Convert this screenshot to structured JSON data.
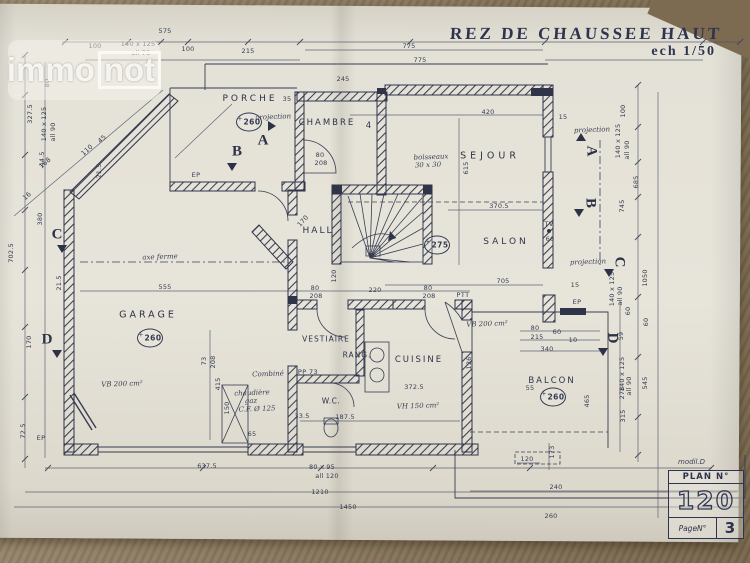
{
  "photo": {
    "table_color": "#8a795f",
    "paper_color": "#e4e1d7",
    "ink_color": "#30354a"
  },
  "watermark": {
    "immo": "immo",
    "not": "not"
  },
  "title": {
    "main": "REZ DE CHAUSSEE HAUT",
    "scale": "ech 1/50"
  },
  "title_block": {
    "model": "modil.D",
    "plan_label": "PLAN N°",
    "plan_number": "120",
    "page_label": "PageN°",
    "page_number": "3"
  },
  "rooms": [
    {
      "label": "PORCHE",
      "x": 250,
      "y": 99,
      "fs": 9,
      "ls": 3
    },
    {
      "label": "CHAMBRE",
      "x": 327,
      "y": 123,
      "fs": 8.5,
      "ls": 2
    },
    {
      "label": "4",
      "x": 370,
      "y": 126,
      "fs": 8.5,
      "ls": 0
    },
    {
      "label": "SEJOUR",
      "x": 490,
      "y": 156,
      "fs": 9.5,
      "ls": 4
    },
    {
      "label": "HALL",
      "x": 318,
      "y": 231,
      "fs": 9,
      "ls": 2
    },
    {
      "label": "SALON",
      "x": 506,
      "y": 242,
      "fs": 9,
      "ls": 3
    },
    {
      "label": "GARAGE",
      "x": 148,
      "y": 315,
      "fs": 9.5,
      "ls": 3
    },
    {
      "label": "VESTIAIRE",
      "x": 326,
      "y": 339,
      "fs": 7.5,
      "ls": 1
    },
    {
      "label": "RANG.",
      "x": 357,
      "y": 355,
      "fs": 7.5,
      "ls": 1
    },
    {
      "label": "CUISINE",
      "x": 419,
      "y": 360,
      "fs": 8.5,
      "ls": 2
    },
    {
      "label": "W.C.",
      "x": 331,
      "y": 401,
      "fs": 7.5,
      "ls": 0.5
    },
    {
      "label": "BALCON",
      "x": 552,
      "y": 381,
      "fs": 8.5,
      "ls": 2
    }
  ],
  "level_markers": [
    {
      "value": "260",
      "x": 249,
      "y": 122
    },
    {
      "value": "275",
      "x": 437,
      "y": 245
    },
    {
      "value": "260",
      "x": 150,
      "y": 338
    },
    {
      "value": "260",
      "x": 553,
      "y": 397
    }
  ],
  "section_markers": [
    {
      "letter": "A",
      "x": 263,
      "y": 141,
      "rot": 0,
      "tx": 272,
      "ty": 126,
      "dir": "right"
    },
    {
      "letter": "B",
      "x": 237,
      "y": 152,
      "rot": 0,
      "tx": 232,
      "ty": 167,
      "dir": "down"
    },
    {
      "letter": "A",
      "x": 591,
      "y": 151,
      "rot": 90,
      "tx": 581,
      "ty": 137,
      "dir": "up"
    },
    {
      "letter": "B",
      "x": 590,
      "y": 203,
      "rot": 90,
      "tx": 579,
      "ty": 213,
      "dir": "down"
    },
    {
      "letter": "C",
      "x": 57,
      "y": 235,
      "rot": 0,
      "tx": 62,
      "ty": 249,
      "dir": "down"
    },
    {
      "letter": "C",
      "x": 619,
      "y": 262,
      "rot": 90,
      "tx": 609,
      "ty": 273,
      "dir": "down"
    },
    {
      "letter": "D",
      "x": 47,
      "y": 340,
      "rot": 0,
      "tx": 57,
      "ty": 354,
      "dir": "down"
    },
    {
      "letter": "D",
      "x": 612,
      "y": 338,
      "rot": 90,
      "tx": 603,
      "ty": 352,
      "dir": "down"
    }
  ],
  "annotations": {
    "script": [
      {
        "t": "projection",
        "x": 273,
        "y": 117
      },
      {
        "t": "projection",
        "x": 592,
        "y": 130
      },
      {
        "t": "projection",
        "x": 588,
        "y": 262
      },
      {
        "t": "axe ferme",
        "x": 160,
        "y": 257
      },
      {
        "t": "boisseaux",
        "x": 431,
        "y": 157
      },
      {
        "t": "30 x 30",
        "x": 428,
        "y": 165
      },
      {
        "t": "VB 200 cm²",
        "x": 122,
        "y": 384
      },
      {
        "t": "VB 200 cm²",
        "x": 487,
        "y": 324
      },
      {
        "t": "VH 150 cm²",
        "x": 418,
        "y": 406
      },
      {
        "t": "chaudière",
        "x": 252,
        "y": 393
      },
      {
        "t": "gaz",
        "x": 251,
        "y": 401
      },
      {
        "t": "C.F. Ø 125",
        "x": 257,
        "y": 409
      },
      {
        "t": "Combiné",
        "x": 268,
        "y": 374
      }
    ],
    "print": [
      {
        "t": "TV",
        "x": 549,
        "y": 224
      },
      {
        "t": "PTT",
        "x": 463,
        "y": 295
      },
      {
        "t": "EP",
        "x": 196,
        "y": 175
      },
      {
        "t": "EP",
        "x": 577,
        "y": 302
      },
      {
        "t": "EP",
        "x": 41,
        "y": 438
      },
      {
        "t": "PP 73",
        "x": 308,
        "y": 372
      }
    ]
  },
  "dimensions": [
    {
      "t": "575",
      "x": 165,
      "y": 31,
      "r": 0
    },
    {
      "t": "100",
      "x": 95,
      "y": 46,
      "r": 0
    },
    {
      "t": "140 x 125",
      "x": 138,
      "y": 44,
      "r": 0
    },
    {
      "t": "all 75",
      "x": 141,
      "y": 53,
      "r": 0
    },
    {
      "t": "100",
      "x": 188,
      "y": 49,
      "r": 0
    },
    {
      "t": "215",
      "x": 248,
      "y": 51,
      "r": 0
    },
    {
      "t": "775",
      "x": 409,
      "y": 46,
      "r": 0
    },
    {
      "t": "775",
      "x": 420,
      "y": 60,
      "r": 0
    },
    {
      "t": "245",
      "x": 343,
      "y": 79,
      "r": 0
    },
    {
      "t": "35",
      "x": 287,
      "y": 99,
      "r": 0
    },
    {
      "t": "80",
      "x": 47,
      "y": 83,
      "r": -90
    },
    {
      "t": "327.5",
      "x": 30,
      "y": 114,
      "r": -90
    },
    {
      "t": "140 x 125",
      "x": 44,
      "y": 124,
      "r": -90
    },
    {
      "t": "all 90",
      "x": 53,
      "y": 132,
      "r": -90
    },
    {
      "t": "44.5",
      "x": 42,
      "y": 159,
      "r": -90
    },
    {
      "t": "380",
      "x": 40,
      "y": 219,
      "r": -90
    },
    {
      "t": "702.5",
      "x": 11,
      "y": 253,
      "r": -90
    },
    {
      "t": "21.5",
      "x": 99,
      "y": 171,
      "r": -90
    },
    {
      "t": "21.5",
      "x": 59,
      "y": 283,
      "r": -90
    },
    {
      "t": "170",
      "x": 29,
      "y": 342,
      "r": -90
    },
    {
      "t": "72.5",
      "x": 23,
      "y": 431,
      "r": -90
    },
    {
      "t": "168",
      "x": 45,
      "y": 163,
      "r": -42
    },
    {
      "t": "110",
      "x": 87,
      "y": 150,
      "r": -42
    },
    {
      "t": "16",
      "x": 27,
      "y": 196,
      "r": -42
    },
    {
      "t": "45",
      "x": 102,
      "y": 139,
      "r": -42
    },
    {
      "t": "100",
      "x": 623,
      "y": 111,
      "r": -90
    },
    {
      "t": "140 x 125",
      "x": 618,
      "y": 141,
      "r": -90
    },
    {
      "t": "all 90",
      "x": 627,
      "y": 150,
      "r": -90
    },
    {
      "t": "685",
      "x": 636,
      "y": 182,
      "r": -90
    },
    {
      "t": "745",
      "x": 622,
      "y": 206,
      "r": -90
    },
    {
      "t": "1050",
      "x": 645,
      "y": 278,
      "r": -90
    },
    {
      "t": "140 x 125",
      "x": 612,
      "y": 289,
      "r": -90
    },
    {
      "t": "all 90",
      "x": 620,
      "y": 296,
      "r": -90
    },
    {
      "t": "60",
      "x": 628,
      "y": 311,
      "r": -90
    },
    {
      "t": "60",
      "x": 646,
      "y": 322,
      "r": -90
    },
    {
      "t": "59",
      "x": 621,
      "y": 336,
      "r": -90
    },
    {
      "t": "140 x 125",
      "x": 622,
      "y": 374,
      "r": -90
    },
    {
      "t": "all 90",
      "x": 629,
      "y": 386,
      "r": -90
    },
    {
      "t": "278",
      "x": 622,
      "y": 393,
      "r": -90
    },
    {
      "t": "315",
      "x": 623,
      "y": 416,
      "r": -90
    },
    {
      "t": "545",
      "x": 645,
      "y": 383,
      "r": -90
    },
    {
      "t": "465",
      "x": 587,
      "y": 401,
      "r": -90
    },
    {
      "t": "637.5",
      "x": 207,
      "y": 466,
      "r": 0
    },
    {
      "t": "80 x 95",
      "x": 322,
      "y": 467,
      "r": 0
    },
    {
      "t": "all 120",
      "x": 327,
      "y": 476,
      "r": 0
    },
    {
      "t": "1210",
      "x": 320,
      "y": 492,
      "r": 0
    },
    {
      "t": "1450",
      "x": 348,
      "y": 507,
      "r": 0
    },
    {
      "t": "120",
      "x": 527,
      "y": 459,
      "r": 0
    },
    {
      "t": "173",
      "x": 552,
      "y": 452,
      "r": -90
    },
    {
      "t": "240",
      "x": 556,
      "y": 487,
      "r": 0
    },
    {
      "t": "260",
      "x": 551,
      "y": 516,
      "r": 0
    },
    {
      "t": "420",
      "x": 488,
      "y": 112,
      "r": 0
    },
    {
      "t": "615",
      "x": 466,
      "y": 168,
      "r": -90
    },
    {
      "t": "370.5",
      "x": 499,
      "y": 206,
      "r": 0
    },
    {
      "t": "705",
      "x": 503,
      "y": 281,
      "r": 0
    },
    {
      "t": "15",
      "x": 575,
      "y": 285,
      "r": 0
    },
    {
      "t": "15",
      "x": 563,
      "y": 117,
      "r": 0
    },
    {
      "t": "555",
      "x": 165,
      "y": 287,
      "r": 0
    },
    {
      "t": "80",
      "x": 315,
      "y": 288,
      "r": 0
    },
    {
      "t": "208",
      "x": 316,
      "y": 296,
      "r": 0
    },
    {
      "t": "80",
      "x": 428,
      "y": 288,
      "r": 0
    },
    {
      "t": "208",
      "x": 429,
      "y": 296,
      "r": 0
    },
    {
      "t": "80",
      "x": 320,
      "y": 155,
      "r": 0
    },
    {
      "t": "208",
      "x": 321,
      "y": 163,
      "r": 0
    },
    {
      "t": "220",
      "x": 375,
      "y": 290,
      "r": 0
    },
    {
      "t": "120",
      "x": 334,
      "y": 276,
      "r": -90
    },
    {
      "t": "170",
      "x": 303,
      "y": 221,
      "r": -48
    },
    {
      "t": "73",
      "x": 204,
      "y": 361,
      "r": -90
    },
    {
      "t": "208",
      "x": 213,
      "y": 362,
      "r": -90
    },
    {
      "t": "415",
      "x": 218,
      "y": 384,
      "r": -90
    },
    {
      "t": "372.5",
      "x": 414,
      "y": 387,
      "r": 0
    },
    {
      "t": "126",
      "x": 469,
      "y": 363,
      "r": -90
    },
    {
      "t": "33.5",
      "x": 302,
      "y": 416,
      "r": 0
    },
    {
      "t": "187.5",
      "x": 345,
      "y": 417,
      "r": 0
    },
    {
      "t": "150",
      "x": 227,
      "y": 408,
      "r": -90
    },
    {
      "t": "65",
      "x": 252,
      "y": 434,
      "r": 0
    },
    {
      "t": "60",
      "x": 550,
      "y": 239,
      "r": 0
    },
    {
      "t": "80",
      "x": 535,
      "y": 328,
      "r": 0
    },
    {
      "t": "60",
      "x": 557,
      "y": 332,
      "r": 0
    },
    {
      "t": "215",
      "x": 537,
      "y": 337,
      "r": 0
    },
    {
      "t": "10",
      "x": 573,
      "y": 340,
      "r": 0
    },
    {
      "t": "340",
      "x": 547,
      "y": 349,
      "r": 0
    },
    {
      "t": "55",
      "x": 530,
      "y": 388,
      "r": 0
    }
  ]
}
